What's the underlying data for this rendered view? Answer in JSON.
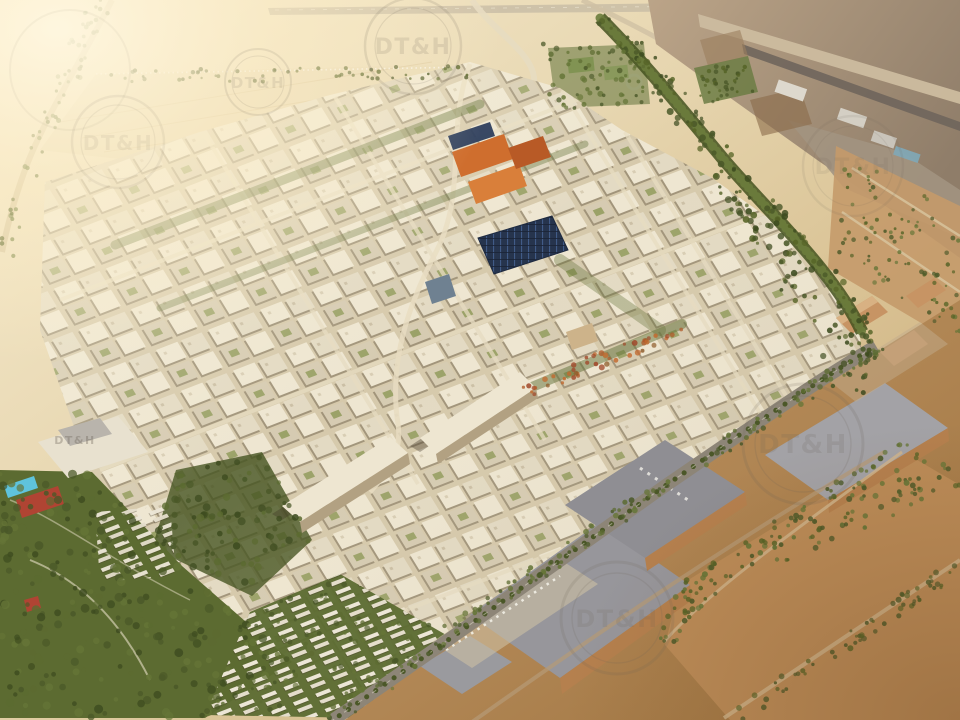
{
  "scene": {
    "type": "aerial-3d-masterplan-render",
    "description": "Sunlit aerial rendering of a desert city masterplan: dense beige mid-rise blocks with green corridors, an orange-roofed quarter, a photovoltaic-roofed market hall, villa neighbourhoods in parkland, logistics warehouses along a tree-lined boulevard, and an airport construction zone in the upper right under warm haze.",
    "watermark": {
      "text": "DT&H"
    }
  },
  "palette": {
    "sandLight": "#f8efd4",
    "sand": "#e8d8b2",
    "sandDeep": "#d5bd8f",
    "desert": "#c49a6a",
    "desertDark": "#a87c4a",
    "lot": "#bc8c58",
    "field": "#eadcb8",
    "airportGround": "#b29c82",
    "airportDark": "#8f7d69",
    "runwayLight": "#ccbc9f",
    "tarmac": "#6f655c",
    "street": "#d6c9ab",
    "bldgLight": "#eee6d1",
    "bldg": "#e3dac3",
    "bldgDark": "#d6cbb2",
    "green": "#5c6b31",
    "greenDark": "#44521f",
    "greenBright": "#6c7c3c",
    "road": "#8d8577",
    "roadLight": "#e7dcc1",
    "whRoof": "#97969b",
    "whWall": "#b5804e",
    "indTan": "#c79464",
    "orange": "#cf6e2e",
    "orangeDark": "#b85a26",
    "pv": "#26344d",
    "pvLine": "#44608d",
    "glass": "#6f8191",
    "pool": "#5fc3dc",
    "court": "#b04433",
    "glare": "#fff7e0",
    "wm": "#6b6257"
  },
  "scatter": [
    {
      "name": "left-park-trees",
      "poly": [
        [
          0,
          468
        ],
        [
          92,
          470
        ],
        [
          182,
          566
        ],
        [
          292,
          662
        ],
        [
          205,
          718
        ],
        [
          0,
          718
        ]
      ],
      "count": 240,
      "rmin": 2,
      "rmax": 4.5,
      "colors": [
        "#5c6b31",
        "#4a5828",
        "#657537",
        "#3e4c20"
      ],
      "op": 0.85
    },
    {
      "name": "villa-garden-trees",
      "poly": [
        [
          205,
          715
        ],
        [
          250,
          612
        ],
        [
          340,
          574
        ],
        [
          448,
          636
        ],
        [
          362,
          718
        ]
      ],
      "count": 110,
      "rmin": 1.5,
      "rmax": 3,
      "colors": [
        "#5c6b31",
        "#4a5828",
        "#657537"
      ],
      "op": 0.8
    },
    {
      "name": "city-park-trees",
      "poly": [
        [
          152,
          548
        ],
        [
          176,
          470
        ],
        [
          262,
          452
        ],
        [
          312,
          540
        ],
        [
          252,
          596
        ]
      ],
      "count": 90,
      "rmin": 2,
      "rmax": 4,
      "colors": [
        "#4a5828",
        "#5c6b31",
        "#3e4c20"
      ],
      "op": 0.9
    },
    {
      "name": "airport-belt-trees",
      "poly": [
        [
          592,
          14
        ],
        [
          624,
          16
        ],
        [
          734,
          155
        ],
        [
          872,
          312
        ],
        [
          876,
          398
        ],
        [
          846,
          396
        ],
        [
          700,
          162
        ]
      ],
      "count": 170,
      "rmin": 1.5,
      "rmax": 3.5,
      "colors": [
        "#4a5828",
        "#556326",
        "#3e4c20"
      ],
      "op": 0.9
    },
    {
      "name": "boulevard-trees",
      "poly": [
        [
          318,
          712
        ],
        [
          660,
          478
        ],
        [
          878,
          338
        ],
        [
          886,
          352
        ],
        [
          668,
          492
        ],
        [
          336,
          722
        ]
      ],
      "count": 150,
      "rmin": 1.5,
      "rmax": 3,
      "colors": [
        "#4a5828",
        "#5c6b31",
        "#657537"
      ],
      "op": 0.9
    },
    {
      "name": "industrial-edge-trees",
      "poly": [
        [
          656,
          636
        ],
        [
          688,
          572
        ],
        [
          902,
          442
        ],
        [
          960,
          468
        ],
        [
          960,
          486
        ],
        [
          706,
          598
        ],
        [
          678,
          652
        ]
      ],
      "count": 150,
      "rmin": 1.5,
      "rmax": 3,
      "colors": [
        "#4a5828",
        "#556326",
        "#657537"
      ],
      "op": 0.9
    },
    {
      "name": "sports-zone-trees",
      "poly": [
        [
          540,
          42
        ],
        [
          648,
          38
        ],
        [
          656,
          108
        ],
        [
          552,
          112
        ]
      ],
      "count": 70,
      "rmin": 1.5,
      "rmax": 3,
      "colors": [
        "#5c6b31",
        "#657537",
        "#4a5828"
      ],
      "op": 0.85
    },
    {
      "name": "entry-road-palms",
      "poly": [
        [
          86,
          0
        ],
        [
          118,
          0
        ],
        [
          44,
          158
        ],
        [
          12,
          262
        ],
        [
          0,
          262
        ],
        [
          0,
          238
        ],
        [
          28,
          148
        ]
      ],
      "count": 60,
      "rmin": 1.5,
      "rmax": 2.5,
      "colors": [
        "#6c7c3c",
        "#556326"
      ],
      "op": 0.8
    },
    {
      "name": "field-palm-row",
      "poly": [
        [
          96,
          70
        ],
        [
          468,
          66
        ],
        [
          470,
          80
        ],
        [
          98,
          84
        ]
      ],
      "count": 55,
      "rmin": 1.2,
      "rmax": 2.2,
      "colors": [
        "#45521f",
        "#556326"
      ],
      "op": 0.85
    },
    {
      "name": "autumn-park-trees",
      "poly": [
        [
          516,
          386
        ],
        [
          676,
          318
        ],
        [
          688,
          332
        ],
        [
          528,
          398
        ]
      ],
      "count": 45,
      "rmin": 1.5,
      "rmax": 3,
      "colors": [
        "#b05a2a",
        "#c26a2f",
        "#8f5d2c",
        "#a0482a"
      ],
      "op": 0.9
    },
    {
      "name": "desert-strip-trees",
      "poly": [
        [
          846,
          150
        ],
        [
          960,
          212
        ],
        [
          960,
          340
        ],
        [
          838,
          262
        ]
      ],
      "count": 90,
      "rmin": 1.2,
      "rmax": 2.5,
      "colors": [
        "#556326",
        "#4a5828",
        "#657537"
      ],
      "op": 0.85
    },
    {
      "name": "airport-green-trees",
      "poly": [
        [
          694,
          70
        ],
        [
          748,
          58
        ],
        [
          756,
          92
        ],
        [
          702,
          104
        ]
      ],
      "count": 40,
      "rmin": 1.2,
      "rmax": 2.5,
      "colors": [
        "#4a5828",
        "#556326"
      ],
      "op": 0.85
    },
    {
      "name": "lot-south-trees",
      "poly": [
        [
          724,
          714
        ],
        [
          952,
          560
        ],
        [
          960,
          576
        ],
        [
          746,
          720
        ]
      ],
      "count": 60,
      "rmin": 1.5,
      "rmax": 3,
      "colors": [
        "#4a5828",
        "#556326"
      ],
      "op": 0.85
    }
  ]
}
